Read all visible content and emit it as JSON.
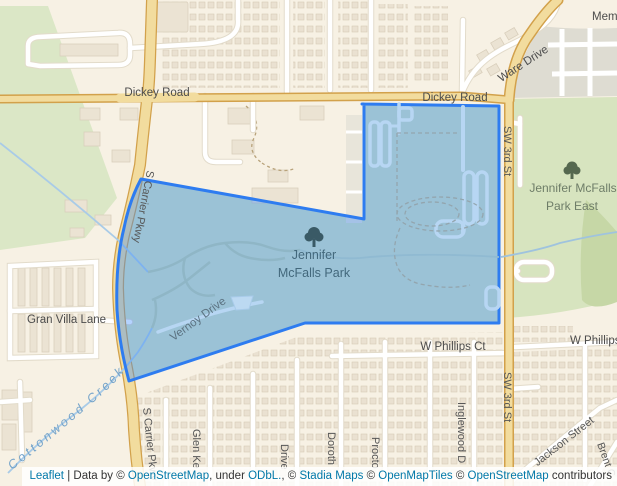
{
  "map": {
    "roads": {
      "dickey_west": "Dickey Road",
      "dickey_east": "Dickey Road",
      "ware": "Ware Drive",
      "carrier_top": "S Carrier Pkwy",
      "carrier_bottom": "S Carrier Pkwy",
      "sw3_top": "SW 3rd St",
      "sw3_bottom": "SW 3rd St",
      "gran_villa": "Gran Villa Lane",
      "vernoy": "Vernoy Drive",
      "w_phillips": "W Phillips Ct",
      "w_phillips_e": "W Phillips",
      "jackson": "Jackson Street",
      "glen": "Glen Ke",
      "drive": "Drive",
      "dorothy": "Doroth",
      "proctor": "Procto",
      "inglewood": "Inglewood D",
      "brent": "Brent C",
      "memorial": "Mem"
    },
    "places": {
      "park_l1": "Jennifer",
      "park_l2": "McFalls Park",
      "park_east_l1": "Jennifer McFalls",
      "park_east_l2": "Park East",
      "creek": "Cottonwood Creek"
    },
    "colors": {
      "overlay_fill": "#3388ff",
      "overlay_fill_opacity": "0.37",
      "overlay_stroke": "#2e7cf0",
      "water": "#aacce8",
      "park_green": "#d7e4bf",
      "road_major_fill": "#f2dc9e",
      "road_major_casing": "#d2a14b",
      "background": "#f7f1e4",
      "link_blue": "#0078a8"
    }
  },
  "attribution": {
    "leaflet": "Leaflet",
    "sep": "|",
    "data_by": "Data by ©",
    "osm1": "OpenStreetMap",
    "under": ", under",
    "odbl": "ODbL.",
    "c1": ", ©",
    "stadia": "Stadia Maps",
    "c2": "©",
    "omt": "OpenMapTiles",
    "c3": "©",
    "osm2": "OpenStreetMap",
    "contributors": "contributors"
  }
}
